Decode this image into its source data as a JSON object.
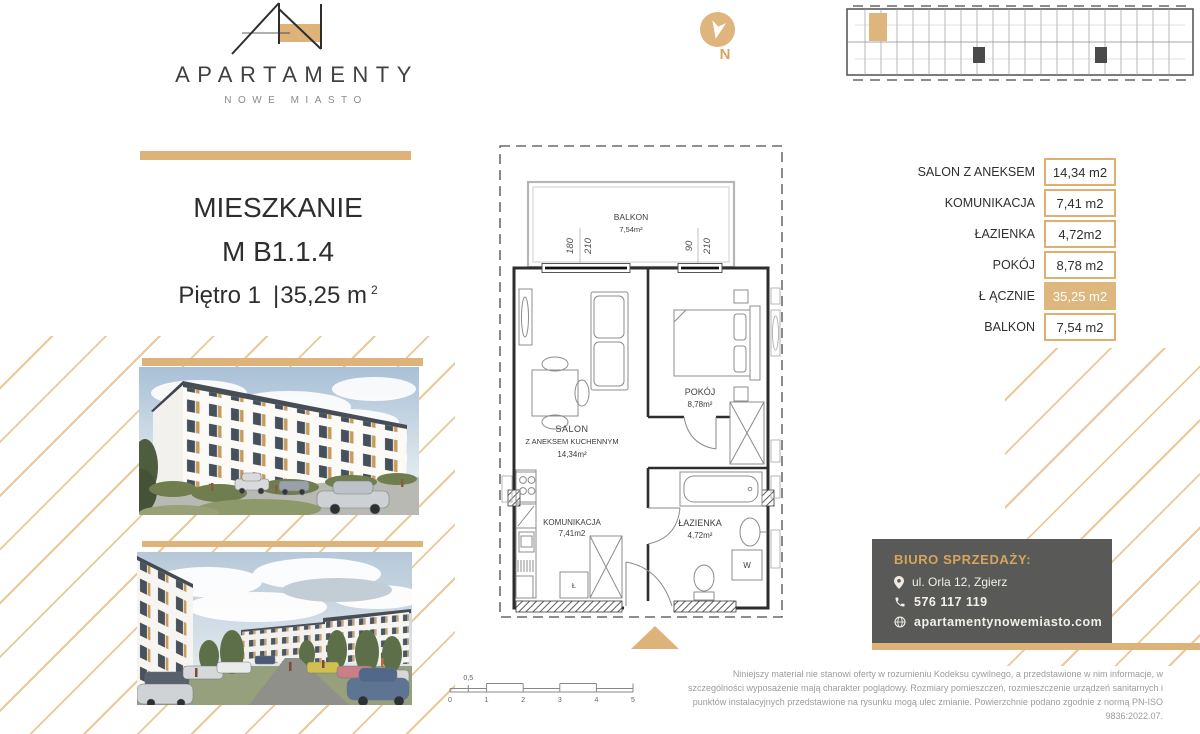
{
  "brand": {
    "name": "APARTAMENTY",
    "tagline": "NOWE MIASTO"
  },
  "compass": {
    "label": "N"
  },
  "unit_card": {
    "title": "MIESZKANIE",
    "unit_no": "M B1.1.4",
    "floor": "Piętro 1",
    "separator": "|",
    "area": "35,25 m",
    "area_exponent": "2"
  },
  "areas_table": {
    "rows": [
      {
        "label": "SALON Z ANEKSEM",
        "value": "14,34 m2",
        "highlight": false
      },
      {
        "label": "KOMUNIKACJA",
        "value": "7,41 m2",
        "highlight": false
      },
      {
        "label": "ŁAZIENKA",
        "value": "4,72m2",
        "highlight": false
      },
      {
        "label": "POKÓJ",
        "value": "8,78 m2",
        "highlight": false
      },
      {
        "label": "Ł ĄCZNIE",
        "value": "35,25 m2",
        "highlight": true
      },
      {
        "label": "BALKON",
        "value": "7,54 m2",
        "highlight": false
      }
    ]
  },
  "floor_plan": {
    "balcony": {
      "name": "BALKON",
      "area": "7,54m²"
    },
    "salon": {
      "name": "SALON",
      "name2": "Z ANEKSEM KUCHENNYM",
      "area": "14,34m²"
    },
    "pokoj": {
      "name": "POKÓJ",
      "area": "8,78m²"
    },
    "komunikacja": {
      "name": "KOMUNIKACJA",
      "area": "7,41m2"
    },
    "lazienka": {
      "name": "ŁAZIENKA",
      "area": "4,72m²"
    },
    "washer": "W",
    "closet": "Ł",
    "window1": {
      "w": "180",
      "h": "210"
    },
    "window2": {
      "w": "90",
      "h": "210"
    }
  },
  "scale_bar": {
    "ticks": [
      "0",
      "1",
      "2",
      "3",
      "4",
      "5"
    ],
    "half": "0,5"
  },
  "contact": {
    "heading": "BIURO SPRZEDAŻY:",
    "address": "ul. Orla 12, Zgierz",
    "phone": "576 117 119",
    "website": "apartamentynowemiasto.com"
  },
  "disclaimer": "Niniejszy materiał nie stanowi oferty w rozumieniu Kodeksu cywilnego, a przedstawione w nim informacje, w szczególności wyposażenie mają charakter poglądowy. Rozmiary pomieszczeń, rozmieszczenie urządzeń sanitarnych i punktów instalacyjnych przedstawione na rysunku mogą ulec zmianie. Powierzchnie podano zgodnie z normą PN-ISO 9836:2022.07.",
  "colors": {
    "gold": "#DEB379",
    "gold_light": "#EAC897",
    "gold_deep": "#D5A55F",
    "dark_text": "#2F2F2F",
    "card_bg": "#595957",
    "highlight_cell": "#DEB77F"
  }
}
